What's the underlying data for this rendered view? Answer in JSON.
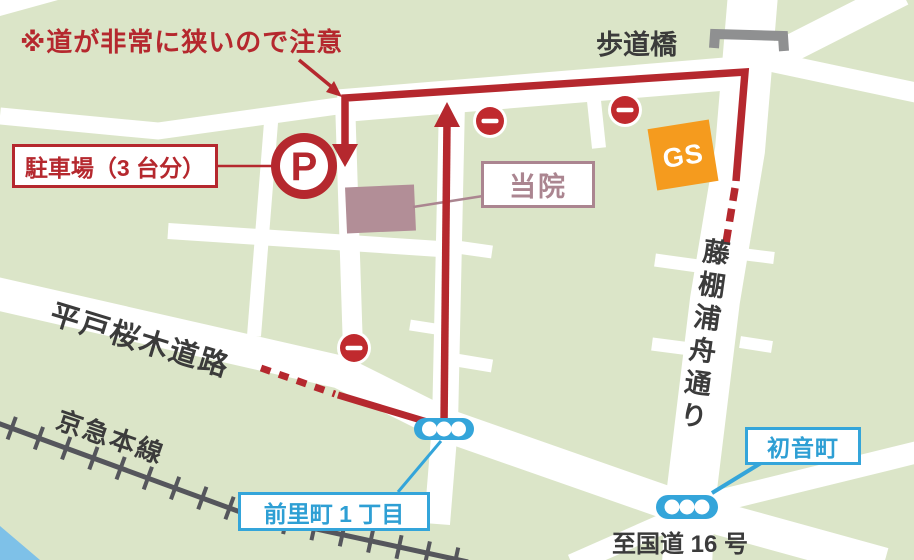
{
  "map": {
    "annotations": {
      "warning_note": "※道が非常に狭いので注意"
    },
    "landmarks": {
      "pedestrian_bridge": {
        "label": "歩道橋"
      },
      "parking": {
        "label": "駐車場（3 台分）",
        "symbol": "P"
      },
      "clinic": {
        "label": "当院"
      },
      "gas_station": {
        "label": "GS"
      }
    },
    "streets": {
      "fujidana_urafune_street": "藤棚浦舟通り",
      "hirado_sakuragi_road": "平戸桜木道路",
      "keikyu_main_line": "京急本線",
      "to_route16": "至国道 16 号"
    },
    "intersections": {
      "maezato_1chome": "前里町 1 丁目",
      "hatsunecho": "初音町"
    },
    "icons": {
      "no_entry_signs": 3,
      "traffic_signals": 2,
      "names": [
        "no-entry-sign-icon",
        "traffic-signal-icon",
        "parking-icon",
        "gas-station-icon",
        "pedestrian-bridge-icon",
        "railway-track-icon"
      ]
    },
    "colors": {
      "background_green": "#dbe5c8",
      "road_white": "#ffffff",
      "route_red": "#b5282e",
      "no_entry_red": "#c02a2e",
      "signal_blue": "#34a5da",
      "clinic_mauve": "#b28e97",
      "gs_orange": "#f59b1e",
      "bridge_gray": "#8f9091",
      "railway_gray": "#55565c",
      "water_blue": "#7ec1e8",
      "text_dark": "#3b3b3b"
    }
  }
}
